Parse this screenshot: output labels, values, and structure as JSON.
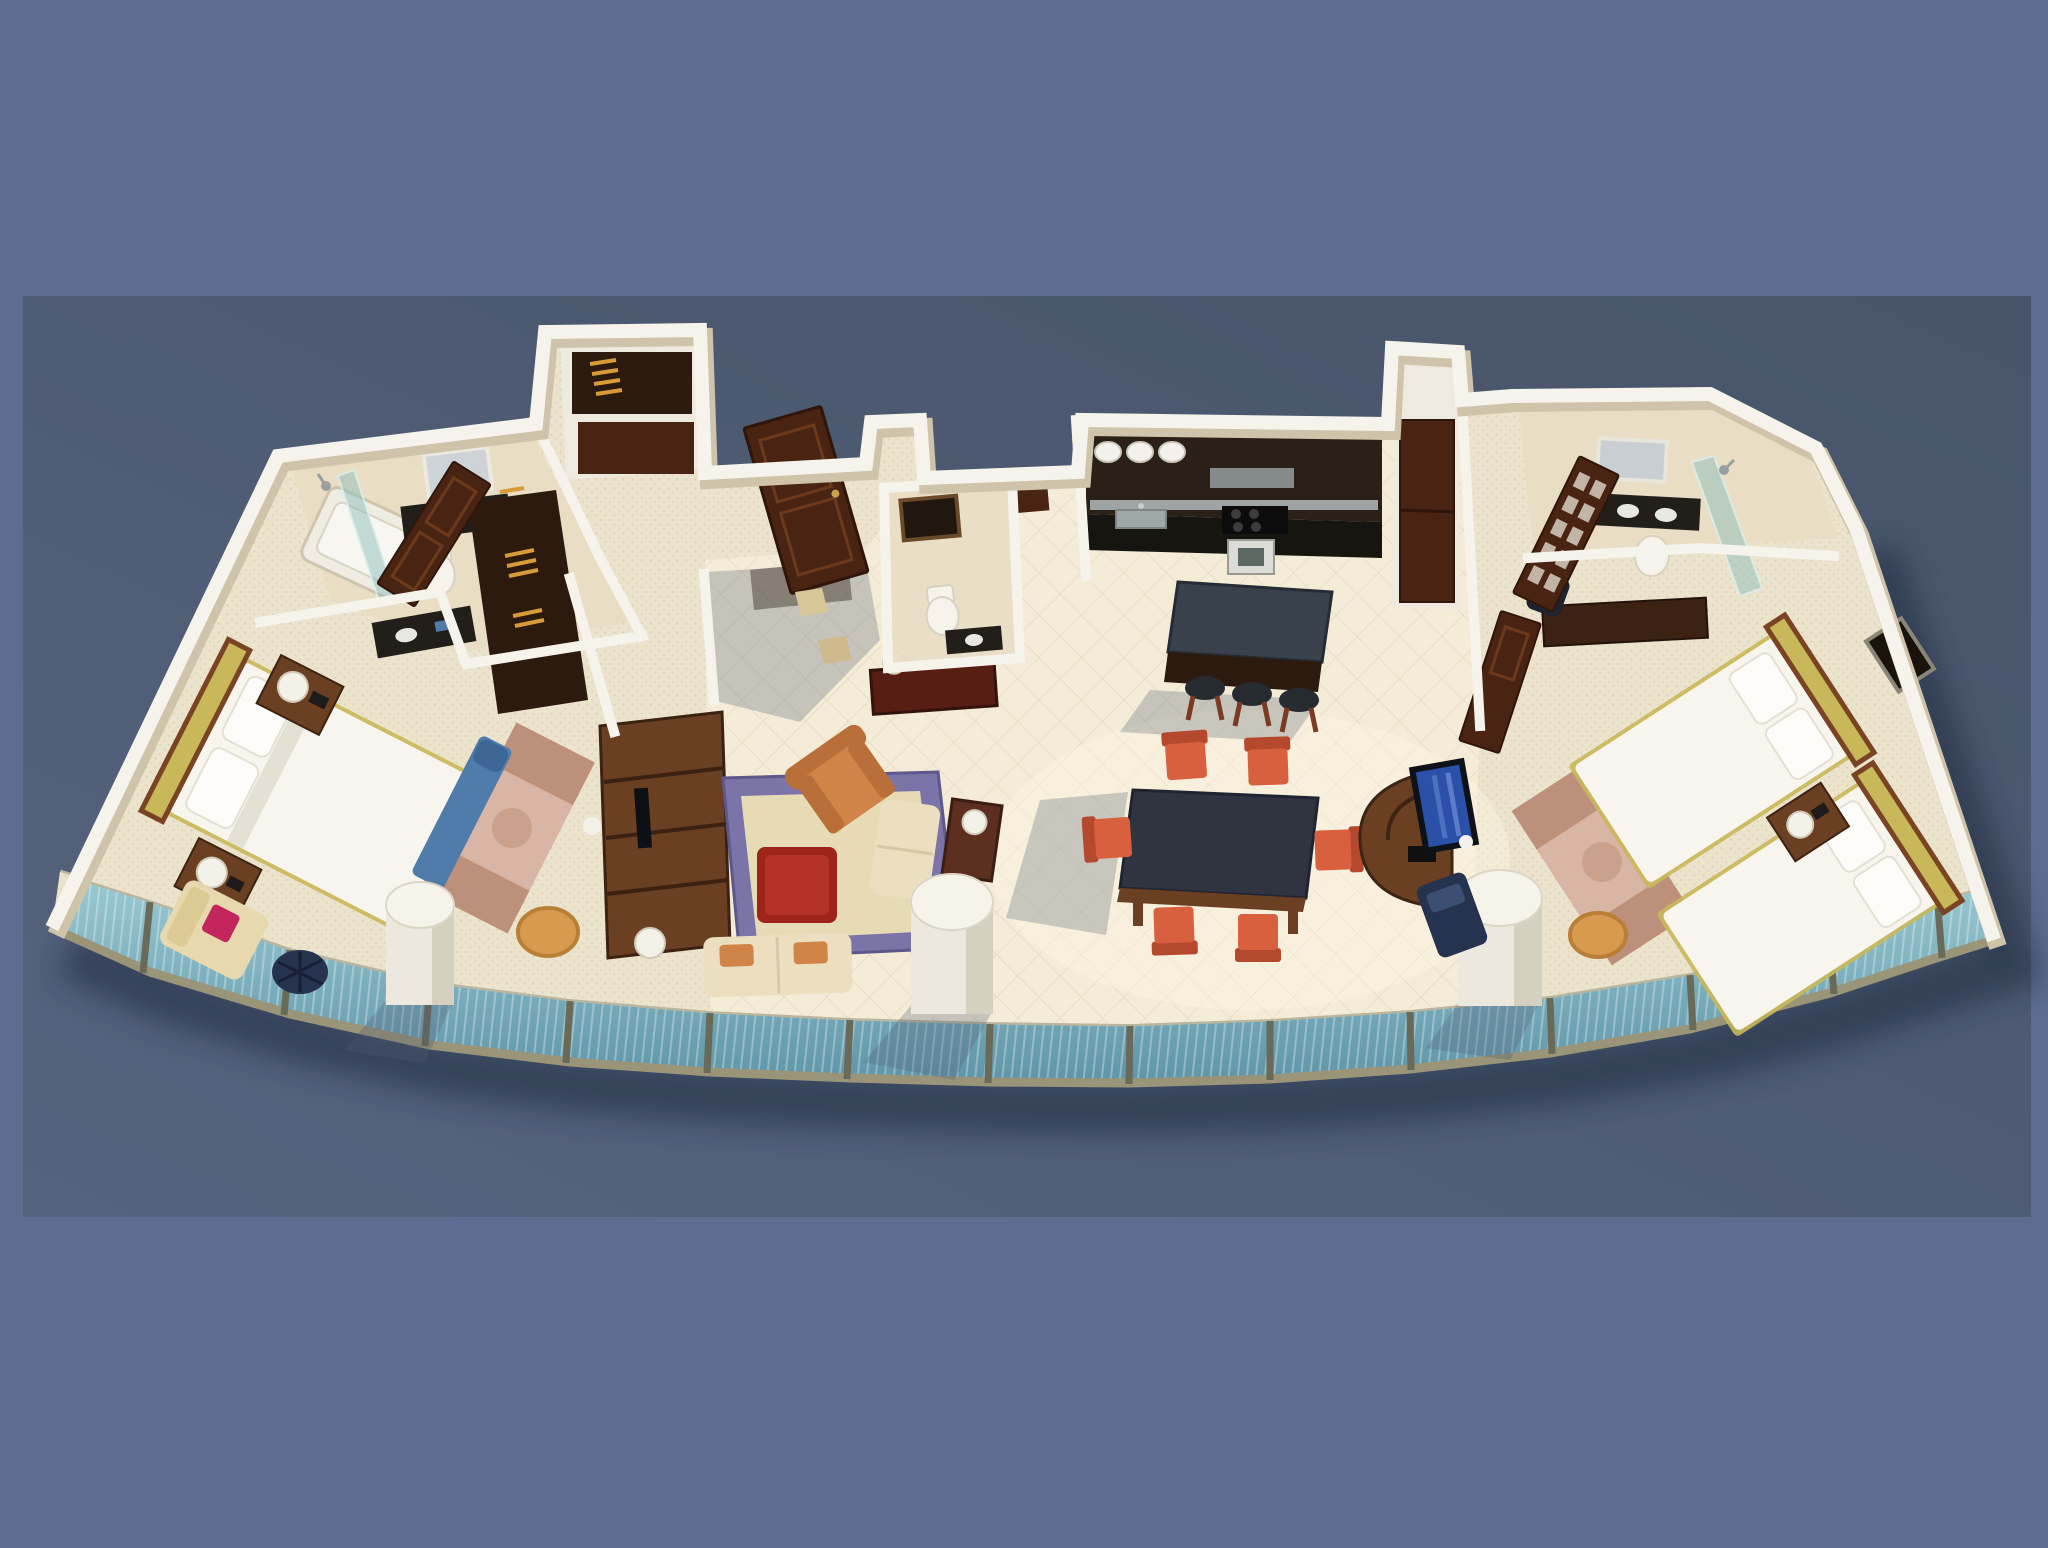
{
  "scene": {
    "kind": "3d-floor-plan-render",
    "description": "Isometric 3D rendered floor plan of a wide two-bedroom suite with a curved floor-to-ceiling glass balcony wall, shown floating over a two-tone blue backdrop",
    "backdrop": {
      "outer": "#5d6c90",
      "panel_dark": "#475469",
      "panel_light": "#55637e"
    },
    "structure": {
      "glass_panels": 14,
      "structural_columns": 3,
      "entry_doors": 1
    },
    "rooms": [
      {
        "name": "master-bedroom",
        "furniture": [
          "double-bed",
          "tufted-headboard",
          "pillows",
          "nightstand",
          "table-lamp",
          "telephone",
          "blue-bench",
          "cream-armchair",
          "wire-stool",
          "area-rug",
          "storage-basket",
          "vanity-nook",
          "toilet",
          "wall-unit"
        ]
      },
      {
        "name": "master-bathroom",
        "furniture": [
          "bathtub",
          "glass-shower-screen",
          "shower-head",
          "toilet",
          "vanity-counter",
          "framed-mirror",
          "towel-rack"
        ]
      },
      {
        "name": "wardrobe-closets",
        "furniture": [
          "open-closet",
          "clothes-hangers",
          "wood-door"
        ]
      },
      {
        "name": "foyer",
        "furniture": [
          "entrance-door",
          "console-table",
          "pair-of-lamps",
          "accent-floor-tiles"
        ]
      },
      {
        "name": "powder-room",
        "furniture": [
          "toilet",
          "vanity-counter",
          "framed-mirror"
        ]
      },
      {
        "name": "living-room",
        "furniture": [
          "bordered-area-rug",
          "red-ottoman",
          "patterned-armchair",
          "cream-sofa",
          "window-loveseat",
          "side-table",
          "table-lamp",
          "floor-lamp"
        ]
      },
      {
        "name": "kitchen",
        "furniture": [
          "dark-cabinet-run",
          "steel-backsplash",
          "cooktop",
          "oven",
          "sink",
          "plate-shelf",
          "island",
          "bar-stool",
          "bar-stool",
          "bar-stool",
          "fridge-pantry"
        ]
      },
      {
        "name": "dining-area",
        "furniture": [
          "dark-top-dining-table",
          "dining-chair",
          "dining-chair",
          "dining-chair",
          "dining-chair",
          "dining-chair",
          "dining-chair"
        ]
      },
      {
        "name": "tv-corner",
        "furniture": [
          "curved-media-console",
          "television"
        ]
      },
      {
        "name": "second-bedroom",
        "furniture": [
          "twin-bed",
          "twin-bed",
          "shared-nightstand",
          "table-lamp",
          "telephone",
          "desk",
          "desk-chair",
          "area-rug",
          "storage-basket",
          "lounge-chair",
          "wall-art"
        ]
      },
      {
        "name": "second-bathroom",
        "furniture": [
          "vanity-counter",
          "framed-mirror",
          "toilet",
          "glass-shower-screen",
          "glass-paneled-door"
        ]
      },
      {
        "name": "balcony-facade",
        "furniture": [
          "teal-glass-panels",
          "frame-posts",
          "white-columns"
        ]
      }
    ]
  },
  "palette": {
    "bg_outer": "#5d6c90",
    "panel_dark": "#475469",
    "panel_light": "#55637e",
    "wall_top": "#f6f3ec",
    "wall_shade": "#cfc3a9",
    "wall_face": "#d9ccb0",
    "floor_carpet": "#ece3cd",
    "floor_tile": "#f4ecd8",
    "bath_floor": "#e9ddc4",
    "glass_top": "#9ccbd4",
    "glass_bottom": "#5f95a8",
    "glass_frame": "#6a6a58",
    "sill": "#9a9478",
    "rail": "#b9b6a0",
    "wood_dark": "#4a2413",
    "wood_mid": "#6b3f22",
    "wood_deep": "#2c1a0e",
    "duvet": "#f8f5ee",
    "pillow": "#fdfcf9",
    "headboard": "#c9b85a",
    "headboard_frame": "#7a4424",
    "bench_blue": "#4f7cab",
    "chair_red": "#d8603f",
    "chair_red_dark": "#b5492e",
    "ottoman_red": "#9e2318",
    "ottoman_red_light": "#b53326",
    "armchair_orange": "#d08448",
    "armchair_orange_dark": "#b96f39",
    "sofa_cream": "#ecdfc0",
    "rug_border": "#7b74a8",
    "rug_center": "#e6dbb4",
    "rug_pink": "#d8b5a5",
    "rug_brown": "#b98a74",
    "counter_dark": "#221e19",
    "island_top": "#39414d",
    "steel": "#aab3b3",
    "stool_seat": "#262a31",
    "tv_screen": "#2b50a8",
    "tv_frame": "#0e1118",
    "lamp": "#f4f1e8",
    "porcelain": "#f6f3ec",
    "basket": "#d89a4e",
    "navy": "#26334e",
    "magenta": "#c2265c",
    "amber": "#d79b3a",
    "column_body": "#ece8dd",
    "column_shade": "#d6d0c0",
    "floor_shadow": "rgba(80,90,115,0.28)"
  }
}
